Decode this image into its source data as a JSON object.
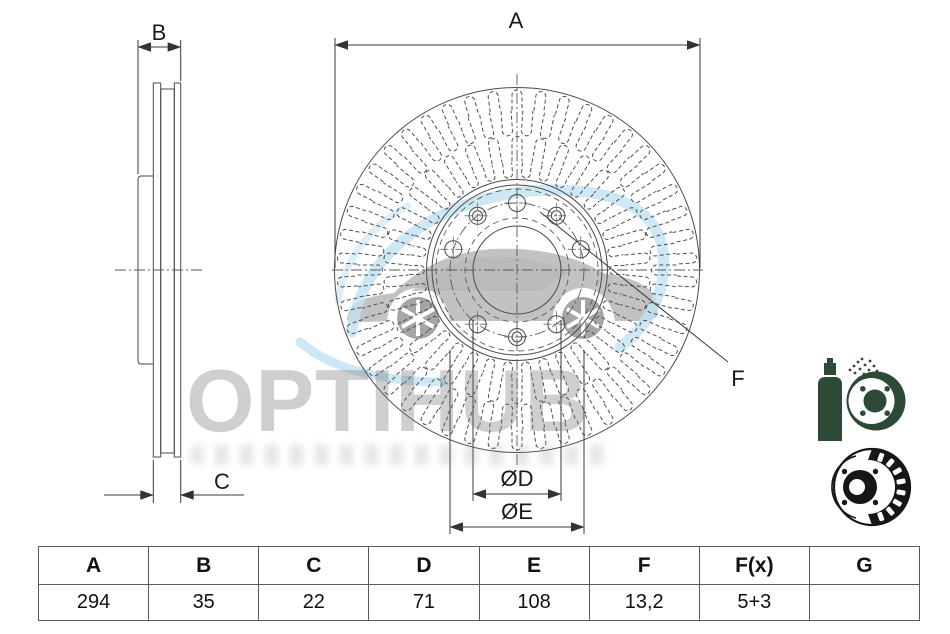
{
  "drawing": {
    "dim_labels": {
      "a": "A",
      "b": "B",
      "c": "C",
      "d": "ØD",
      "e": "ØE",
      "f": "F"
    },
    "line_color": "#4a4a4a"
  },
  "watermark": {
    "text": "OPTIHUB",
    "accent_blue": "#c2e2f2",
    "car_gray": "#b3b3b3"
  },
  "icons": {
    "coated_disc": "spray-coated-disc-icon",
    "vented_disc": "vented-disc-icon",
    "green": "#2c4a36",
    "black": "#161616"
  },
  "table": {
    "headers": [
      "A",
      "B",
      "C",
      "D",
      "E",
      "F",
      "F(x)",
      "G"
    ],
    "values": [
      "294",
      "35",
      "22",
      "71",
      "108",
      "13,2",
      "5+3",
      ""
    ]
  }
}
